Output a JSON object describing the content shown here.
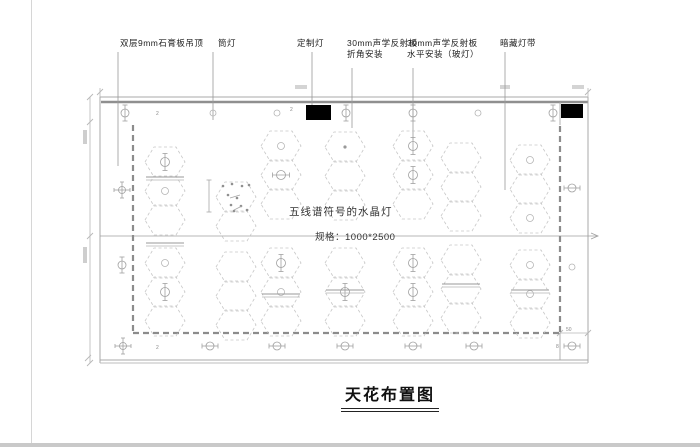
{
  "sheet": {
    "title": "天花布置图"
  },
  "notes": {
    "lamp": "五线谱符号的水晶灯",
    "spec": "规格：1000*2500"
  },
  "callouts": [
    {
      "line1": "双层9mm石膏板吊顶",
      "line2": "",
      "x": 120,
      "leader": {
        "x": 118,
        "y1": 52,
        "y2": 166
      }
    },
    {
      "line1": "筒灯",
      "line2": "",
      "x": 218,
      "leader": {
        "x": 213,
        "y1": 52,
        "y2": 120
      }
    },
    {
      "line1": "定制灯",
      "line2": "",
      "x": 297,
      "leader": {
        "x": 312,
        "y1": 52,
        "y2": 105
      }
    },
    {
      "line1": "30mm声学反射板",
      "line2": "折角安装",
      "x": 347,
      "leader": {
        "x": 352,
        "y1": 68,
        "y2": 128
      }
    },
    {
      "line1": "30mm声学反射板",
      "line2": "水平安装（玻灯）",
      "x": 407,
      "leader": {
        "x": 413,
        "y1": 68,
        "y2": 140
      }
    },
    {
      "line1": "暗藏灯带",
      "line2": "",
      "x": 500,
      "leader": {
        "x": 505,
        "y1": 52,
        "y2": 190
      }
    }
  ],
  "tiny_texts": [
    {
      "t": "2",
      "x": 156,
      "y": 115
    },
    {
      "t": "2",
      "x": 290,
      "y": 111
    },
    {
      "t": "2",
      "x": 156,
      "y": 349
    },
    {
      "t": "8",
      "x": 556,
      "y": 348
    },
    {
      "t": "50",
      "x": 566,
      "y": 331
    }
  ],
  "colors": {
    "thin_line": "#a8a8a8",
    "wall_line": "#8f8f8f",
    "dash_boundary": "#8c8c8c",
    "hex_line": "#c6c6c6",
    "symbol_line": "#a0a0a0",
    "leader_line": "#9a9a9a",
    "dim_line": "#b8b8b8",
    "black_fill": "#000000",
    "text_dark": "#222222",
    "tiny_text": "#8a8a8a"
  },
  "plan": {
    "outer": {
      "x1": 100,
      "y1": 97,
      "x2": 588,
      "y2": 363
    },
    "wall_top_thick_y": 102,
    "bottom_double_y": [
      360,
      363
    ],
    "inner_dashed": {
      "left_x": 133,
      "right_x": 560,
      "top_y": 125,
      "bottom_y": 333
    },
    "right_solid_x": 560,
    "centerline": {
      "y": 236,
      "x1": 100,
      "x2": 598
    },
    "left_dim_x": 90,
    "dim50_line": {
      "y": 333,
      "x1": 560,
      "x2": 588
    },
    "inplan_dim": {
      "x": 209,
      "y1": 180,
      "y2": 212
    },
    "black_rects": [
      {
        "x": 306,
        "y": 105,
        "w": 25,
        "h": 15
      },
      {
        "x": 561,
        "y": 104,
        "w": 22,
        "h": 14
      }
    ],
    "top_strip_symbols": {
      "y": 113,
      "items": [
        {
          "x": 125,
          "t": "v"
        },
        {
          "x": 213,
          "t": "o"
        },
        {
          "x": 277,
          "t": "o"
        },
        {
          "x": 346,
          "t": "v"
        },
        {
          "x": 413,
          "t": "v"
        },
        {
          "x": 478,
          "t": "o"
        },
        {
          "x": 553,
          "t": "v"
        }
      ]
    },
    "bottom_strip_symbols": {
      "y": 346,
      "items": [
        {
          "x": 123,
          "t": "x4"
        },
        {
          "x": 210,
          "t": "h"
        },
        {
          "x": 277,
          "t": "h"
        },
        {
          "x": 345,
          "t": "h"
        },
        {
          "x": 413,
          "t": "h"
        },
        {
          "x": 474,
          "t": "h"
        },
        {
          "x": 572,
          "t": "h"
        }
      ]
    },
    "left_margin_symbols": {
      "x": 122,
      "items": [
        {
          "y": 190,
          "t": "x4"
        },
        {
          "y": 265,
          "t": "v"
        }
      ]
    },
    "right_margin_symbols": {
      "x": 572,
      "items": [
        {
          "y": 188,
          "t": "h"
        },
        {
          "y": 267,
          "t": "o"
        }
      ]
    },
    "hex": {
      "w": 40,
      "h": 30,
      "pitch": 29
    },
    "hex_chains": [
      {
        "cx": 165,
        "top": 147,
        "syms": [
          "v",
          "o",
          "n"
        ]
      },
      {
        "cx": 236,
        "top": 182,
        "syms": [
          "m",
          "n"
        ]
      },
      {
        "cx": 281,
        "top": 131,
        "syms": [
          "o",
          "h",
          "n"
        ]
      },
      {
        "cx": 345,
        "top": 132,
        "syms": [
          "d",
          "n",
          "n"
        ]
      },
      {
        "cx": 413,
        "top": 131,
        "syms": [
          "v",
          "v",
          "n"
        ]
      },
      {
        "cx": 461,
        "top": 143,
        "syms": [
          "n",
          "n",
          "n"
        ]
      },
      {
        "cx": 530,
        "top": 145,
        "syms": [
          "o",
          "n",
          "o"
        ]
      },
      {
        "cx": 165,
        "top": 248,
        "syms": [
          "o",
          "v",
          "n"
        ]
      },
      {
        "cx": 236,
        "top": 252,
        "syms": [
          "n",
          "n",
          "n"
        ]
      },
      {
        "cx": 281,
        "top": 248,
        "syms": [
          "v",
          "o",
          "n"
        ]
      },
      {
        "cx": 345,
        "top": 248,
        "syms": [
          "n",
          "v",
          "n"
        ]
      },
      {
        "cx": 413,
        "top": 248,
        "syms": [
          "v",
          "v",
          "n"
        ]
      },
      {
        "cx": 461,
        "top": 245,
        "syms": [
          "n",
          "n",
          "n"
        ]
      },
      {
        "cx": 530,
        "top": 250,
        "syms": [
          "o",
          "o",
          "n"
        ]
      }
    ],
    "connectors": [
      [
        165,
        177
      ],
      [
        165,
        243
      ],
      [
        281,
        294
      ],
      [
        345,
        290
      ],
      [
        461,
        284
      ],
      [
        530,
        290
      ]
    ],
    "music_dots_center": {
      "cx": 236,
      "cy": 197
    }
  }
}
